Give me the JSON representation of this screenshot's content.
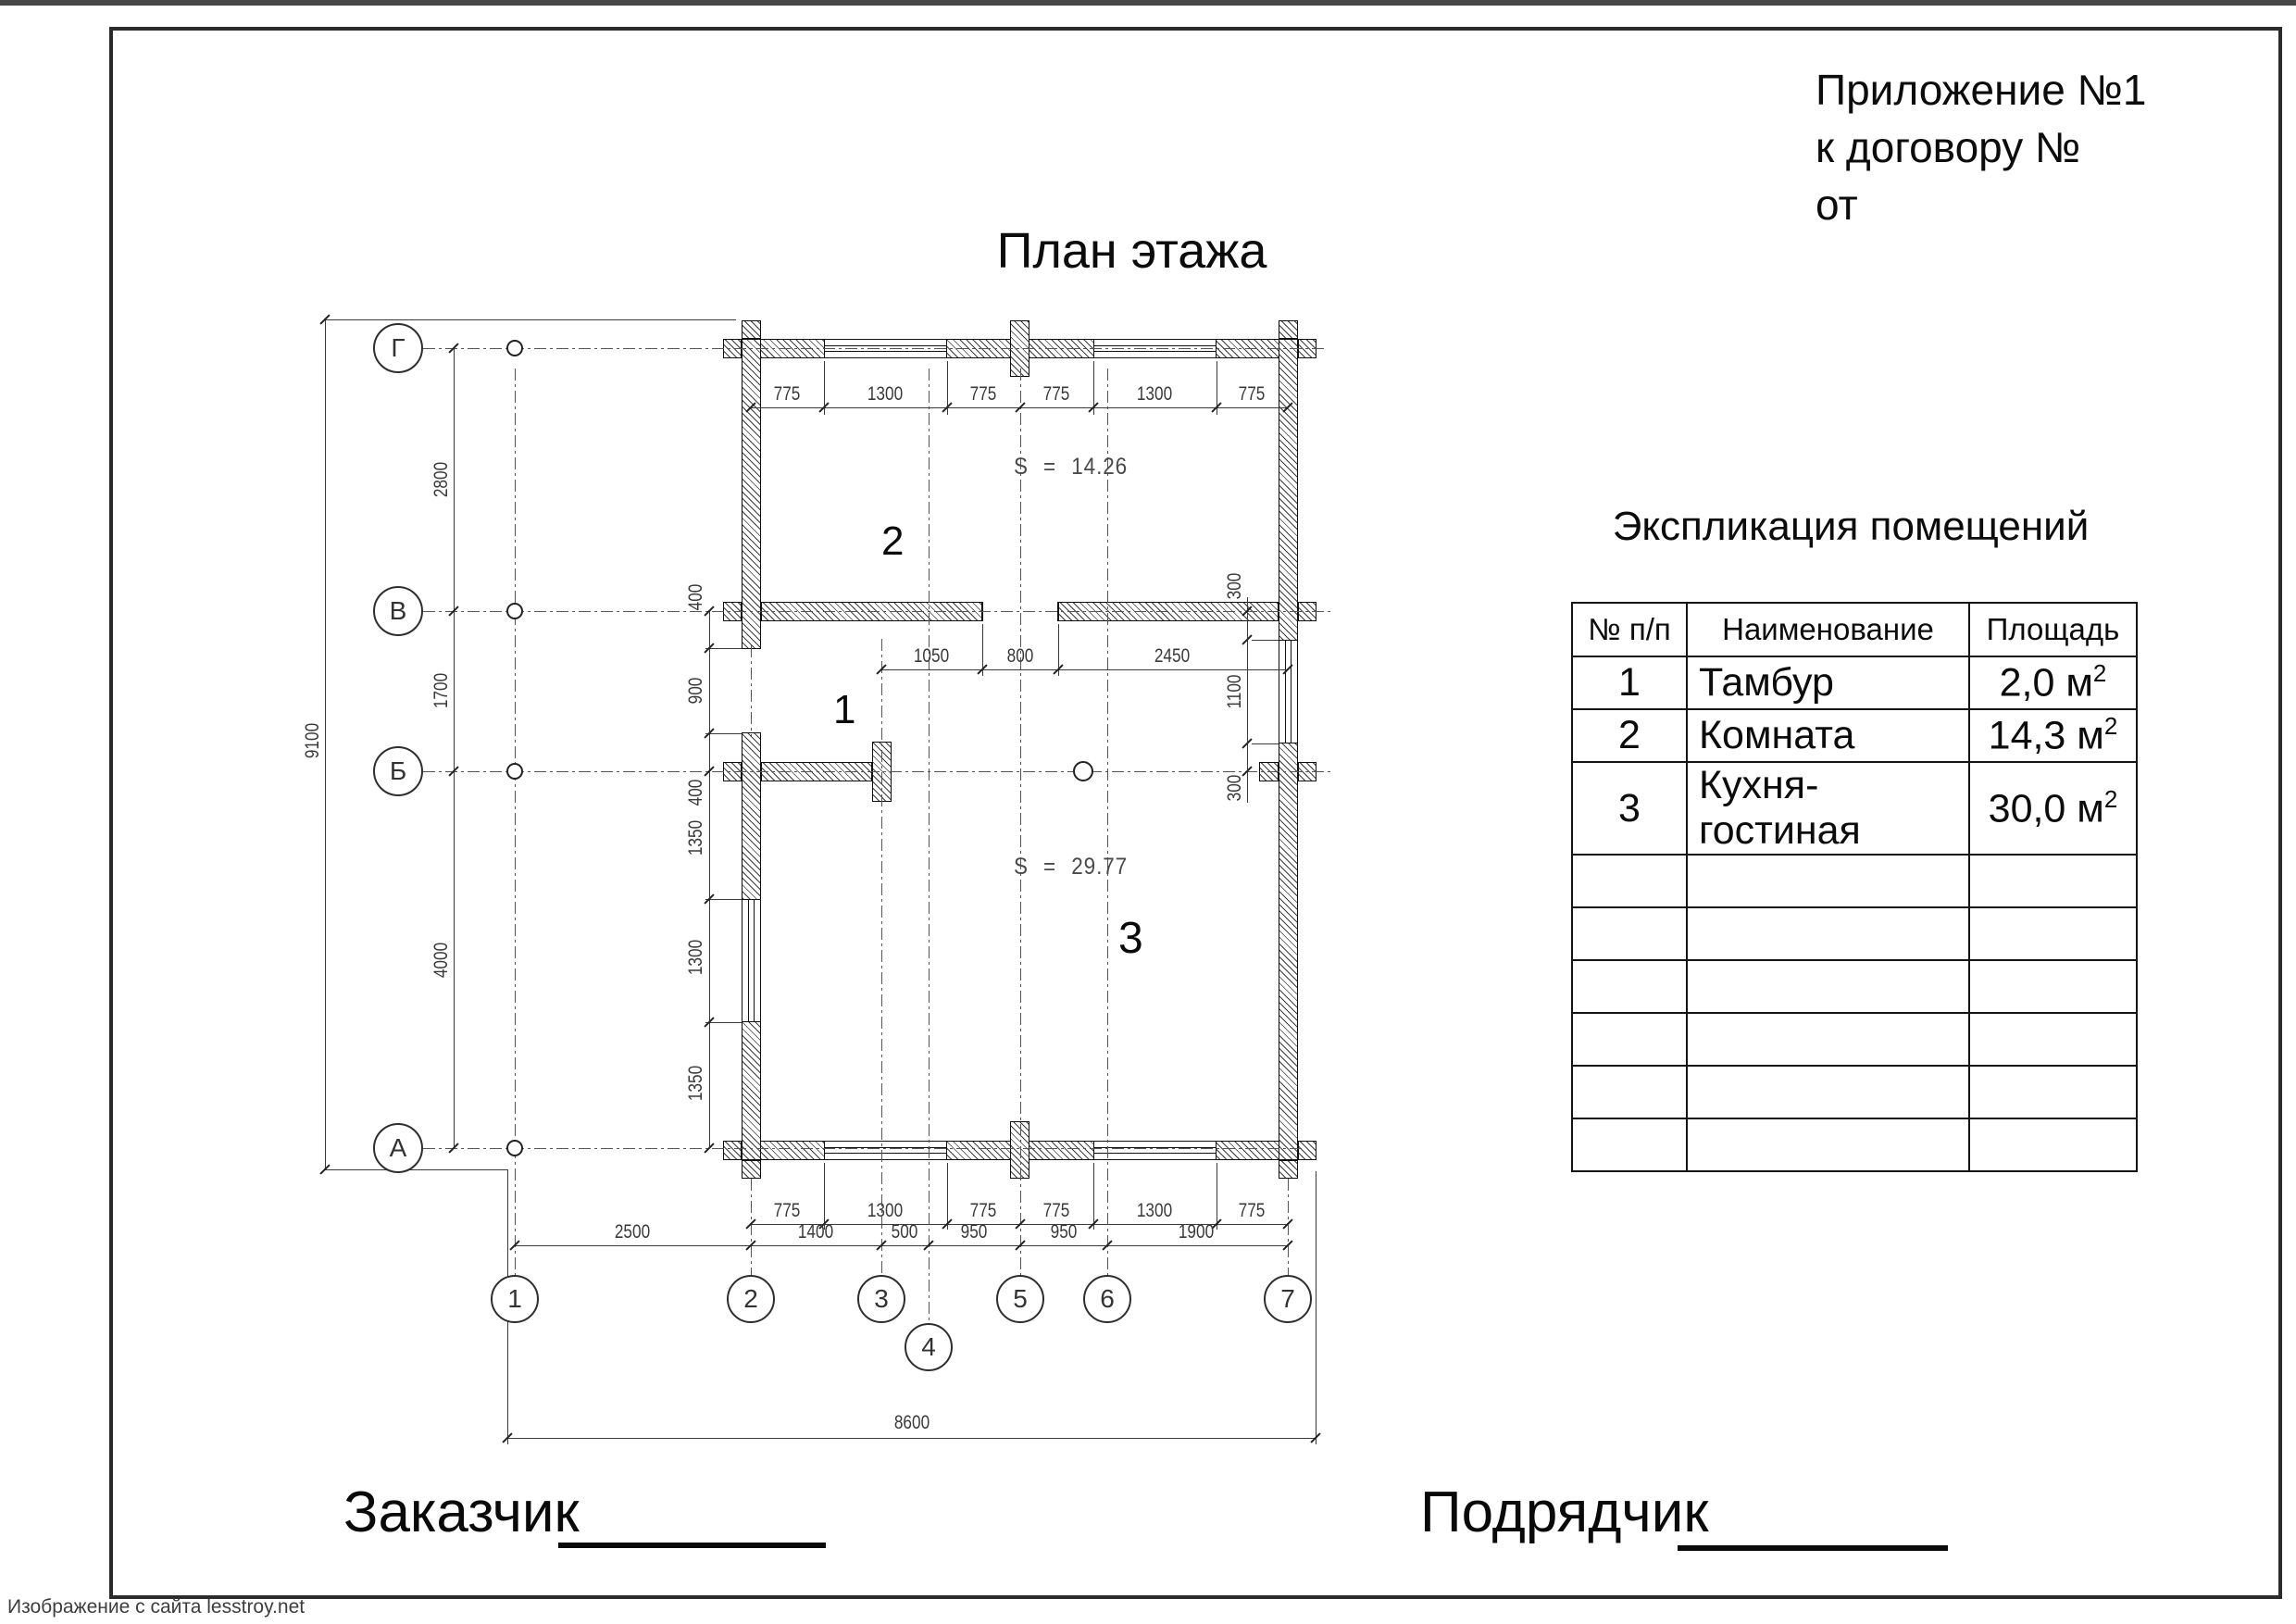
{
  "page": {
    "appendix_lines": [
      "Приложение №1",
      "к договору №",
      "от"
    ],
    "watermark": "Изображение с сайта lesstroy.net"
  },
  "plan": {
    "title": "План этажа",
    "room_numbers": {
      "r1": "1",
      "r2": "2",
      "r3": "3"
    },
    "areas": {
      "room2": "S = 14.26",
      "room3": "S = 29.77"
    },
    "axes": {
      "horizontal": [
        "Г",
        "В",
        "Б",
        "А"
      ],
      "vertical": [
        "1",
        "2",
        "3",
        "4",
        "5",
        "6",
        "7"
      ]
    },
    "dims": {
      "top": [
        "775",
        "1300",
        "775",
        "775",
        "1300",
        "775"
      ],
      "inner": [
        "1050",
        "800",
        "2450"
      ],
      "bottom1": [
        "775",
        "1300",
        "775",
        "775",
        "1300",
        "775"
      ],
      "bottom2": [
        "2500",
        "1400",
        "500",
        "950",
        "950",
        "1900"
      ],
      "total_width": "8600",
      "total_height": "9100",
      "left_axes": [
        "2800",
        "1700",
        "4000"
      ],
      "left_wall": [
        "400",
        "900",
        "400",
        "1350",
        "1300",
        "1350"
      ],
      "right_wall": [
        "300",
        "1100",
        "300"
      ]
    }
  },
  "table": {
    "title": "Экспликация помещений",
    "headers": [
      "№ п/п",
      "Наименование",
      "Площадь"
    ],
    "rows": [
      {
        "num": "1",
        "name": "Тамбур",
        "area": "2,0 м",
        "sup": "2"
      },
      {
        "num": "2",
        "name": "Комната",
        "area": "14,3 м",
        "sup": "2"
      },
      {
        "num": "3",
        "name": "Кухня-гостиная",
        "area": "30,0 м",
        "sup": "2"
      }
    ],
    "empty_row_count": 6
  },
  "footer": {
    "customer": "Заказчик",
    "contractor": "Подрядчик"
  }
}
